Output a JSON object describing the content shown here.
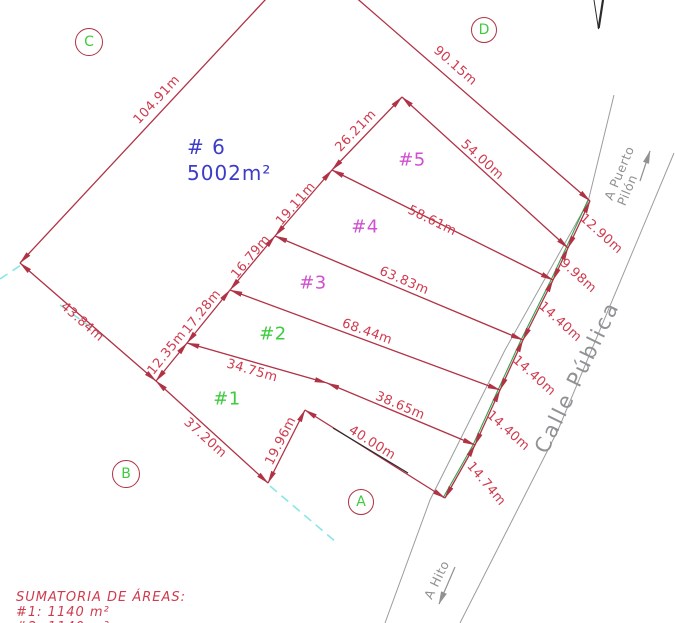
{
  "drawing_type": "cadastral-subdivision-plan",
  "main_lot": {
    "label": "# 6",
    "area": "5002m²",
    "x": 187,
    "y": 134
  },
  "lot_labels": [
    {
      "text": "#1",
      "x": 227,
      "y": 399,
      "color_key": "green"
    },
    {
      "text": "#2",
      "x": 273,
      "y": 334,
      "color_key": "green"
    },
    {
      "text": "#3",
      "x": 313,
      "y": 283,
      "color_key": "magenta"
    },
    {
      "text": "#4",
      "x": 365,
      "y": 227,
      "color_key": "magenta"
    },
    {
      "text": "#5",
      "x": 412,
      "y": 160,
      "color_key": "magenta"
    }
  ],
  "dimensions": [
    {
      "text": "104.91m",
      "x": 157,
      "y": 100,
      "rot": -47
    },
    {
      "text": "90.15m",
      "x": 455,
      "y": 66,
      "rot": 41
    },
    {
      "text": "26.21m",
      "x": 356,
      "y": 131,
      "rot": -46
    },
    {
      "text": "54.00m",
      "x": 482,
      "y": 160,
      "rot": 42
    },
    {
      "text": "58.61m",
      "x": 432,
      "y": 221,
      "rot": 26
    },
    {
      "text": "63.83m",
      "x": 404,
      "y": 281,
      "rot": 23
    },
    {
      "text": "68.44m",
      "x": 367,
      "y": 332,
      "rot": 20
    },
    {
      "text": "34.75m",
      "x": 252,
      "y": 371,
      "rot": 16
    },
    {
      "text": "38.65m",
      "x": 400,
      "y": 406,
      "rot": 23
    },
    {
      "text": "40.00m",
      "x": 372,
      "y": 443,
      "rot": 32
    },
    {
      "text": "19.11m",
      "x": 296,
      "y": 204,
      "rot": -49
    },
    {
      "text": "16.79m",
      "x": 251,
      "y": 257,
      "rot": -50
    },
    {
      "text": "17.28m",
      "x": 202,
      "y": 312,
      "rot": -51
    },
    {
      "text": "12.35m",
      "x": 167,
      "y": 353,
      "rot": -51
    },
    {
      "text": "43.84m",
      "x": 82,
      "y": 322,
      "rot": 41
    },
    {
      "text": "37.20m",
      "x": 205,
      "y": 438,
      "rot": 42
    },
    {
      "text": "19.96m",
      "x": 281,
      "y": 441,
      "rot": -63
    },
    {
      "text": "12.90m",
      "x": 601,
      "y": 234,
      "rot": 42
    },
    {
      "text": "9.98m",
      "x": 578,
      "y": 276,
      "rot": 42
    },
    {
      "text": "14.40m",
      "x": 560,
      "y": 322,
      "rot": 42
    },
    {
      "text": "14.40m",
      "x": 534,
      "y": 376,
      "rot": 42
    },
    {
      "text": "14.40m",
      "x": 508,
      "y": 431,
      "rot": 42
    },
    {
      "text": "14.74m",
      "x": 486,
      "y": 484,
      "rot": 50
    }
  ],
  "corners": [
    {
      "letter": "C",
      "x": 88,
      "y": 41,
      "r": 13
    },
    {
      "letter": "D",
      "x": 483,
      "y": 29,
      "r": 12
    },
    {
      "letter": "B",
      "x": 125,
      "y": 473,
      "r": 13
    },
    {
      "letter": "A",
      "x": 360,
      "y": 501,
      "r": 12
    }
  ],
  "road": {
    "name": "Calle Pública",
    "dest_north_line1": "A Puerto",
    "dest_north_line2": "Pilón",
    "dest_south": "A Hito"
  },
  "summary": {
    "title": "SUMATORIA DE ÁREAS:",
    "lines": [
      "#1:  1140  m²",
      "#2:  1140  m²"
    ]
  },
  "colors": {
    "linered": "#b03245",
    "dimtext": "#cf3b4e",
    "green": "#3ecb3e",
    "magenta": "#cf4fcf",
    "blue": "#3c3cc8",
    "cyan": "#8ae6e6",
    "gray": "#8f9193",
    "boundary_green": "#34a04a",
    "black": "#2b2b2b"
  }
}
